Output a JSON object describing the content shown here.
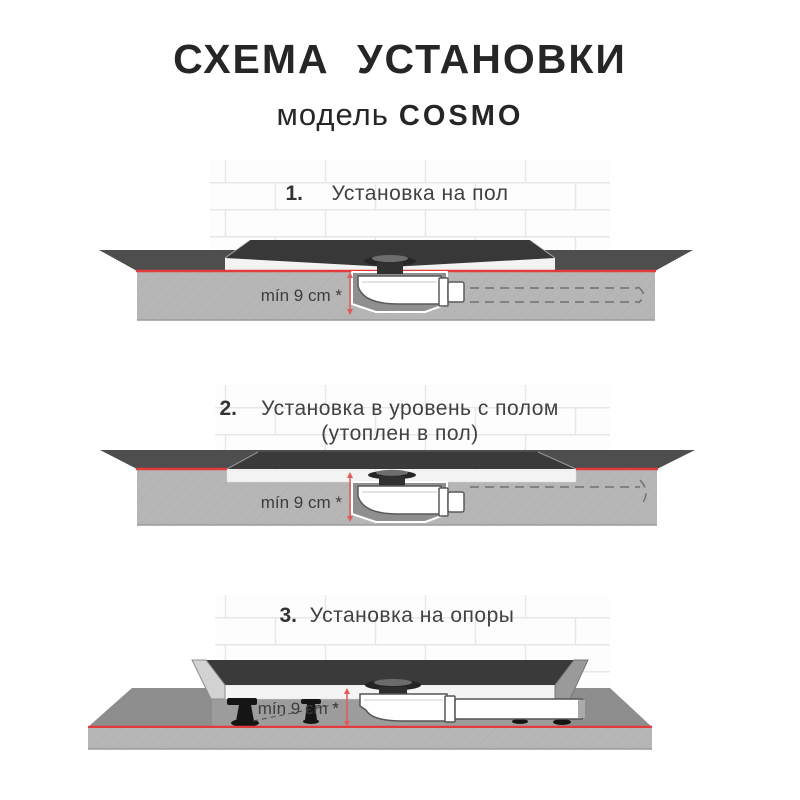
{
  "header": {
    "title": "СХЕМА УСТАНОВКИ",
    "model_label": "модель",
    "model_name": "COSMO"
  },
  "sections": [
    {
      "number": "1.",
      "title": "Установка на пол",
      "dimension": "mín 9 cm *"
    },
    {
      "number": "2.",
      "title": "Установка в уровень с полом",
      "subtitle": "(утоплен в пол)",
      "dimension": "mín 9 cm *"
    },
    {
      "number": "3.",
      "title": "Установка на опоры",
      "dimension": "mín 9 cm *"
    }
  ],
  "colors": {
    "accent_red": "#e23b3b",
    "dimension_red": "#e05b5b",
    "tray_dark": "#3a3a3a",
    "floor_top_dark": "#4e4e4e",
    "floor_top_light": "#8d8d8d",
    "slab_face": "#b6b6b6",
    "cavity": "#8f8f8f",
    "text": "#3d3d3d"
  }
}
